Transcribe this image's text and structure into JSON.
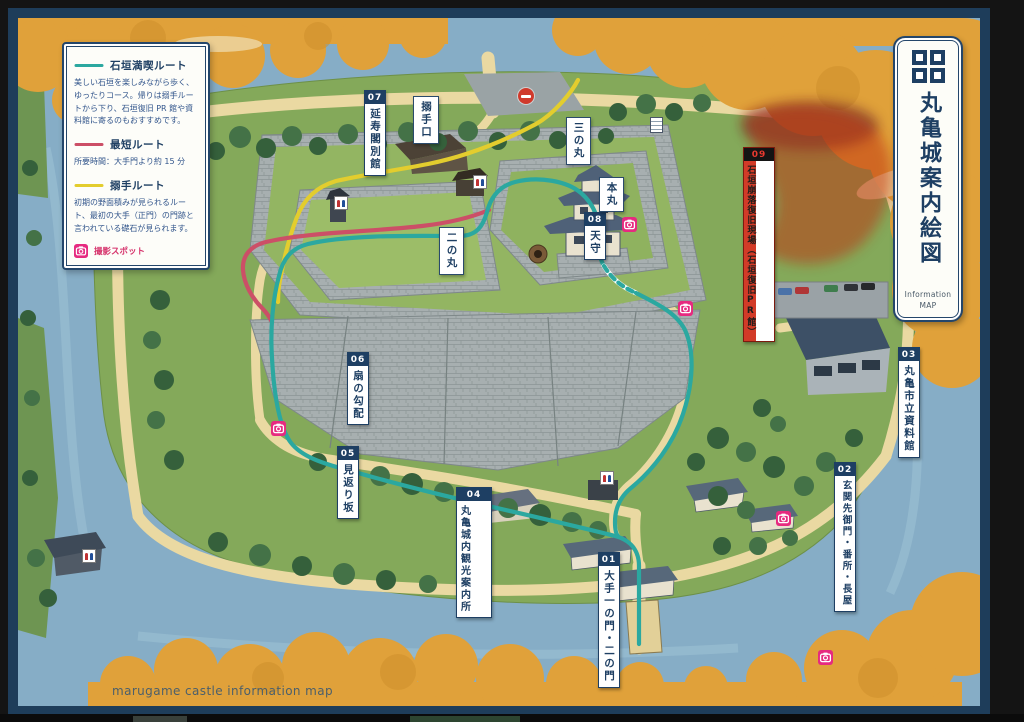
{
  "page": {
    "caption": "marugame castle information map"
  },
  "banner": {
    "title": "丸亀城案内絵図",
    "subtitle1": "Information",
    "subtitle2": "MAP",
    "crest": "marugame-four-squares-crest"
  },
  "legend": {
    "routes": [
      {
        "name": "石垣満喫ルート",
        "color": "#2ba8a0",
        "description": "美しい石垣を楽しみながら歩く、ゆったりコース。帰りは搦手ルートから下り、石垣復旧 PR 館や資料館に寄るのもおすすめです。"
      },
      {
        "name": "最短ルート",
        "color": "#cc4f67",
        "description": "所要時間：大手門より約 15 分"
      },
      {
        "name": "搦手ルート",
        "color": "#e3cd2e",
        "description": "初期の野面積みが見られるルート、最初の大手（正門）の門跡と言われている礎石が見られます。"
      }
    ],
    "photo_spot": "撮影スポット"
  },
  "markers": {
    "m01": {
      "num": "01",
      "label": "大手一の門・二の門"
    },
    "m02": {
      "num": "02",
      "label": "玄関先御門・番所・長屋"
    },
    "m03": {
      "num": "03",
      "label": "丸亀市立資料館"
    },
    "m04": {
      "num": "04",
      "label1": "丸亀城内",
      "label2": "観光案内所"
    },
    "m05": {
      "num": "05",
      "label": "見返り坂"
    },
    "m06": {
      "num": "06",
      "label": "扇の勾配"
    },
    "m07": {
      "num": "07",
      "label": "延寿閣別館"
    },
    "m08": {
      "num": "08",
      "label": "天守"
    },
    "m09": {
      "num": "09",
      "label1": "石垣崩落復旧現場",
      "label2": "（石垣復旧PR館）"
    }
  },
  "place_labels": {
    "karamete": "搦手口",
    "sannomaru": "三の丸",
    "honmaru": "本丸",
    "ninomaru": "二の丸"
  },
  "icons": {
    "photo_spot": {
      "name": "camera-icon",
      "color": "#e62a80"
    },
    "restroom": {
      "name": "restroom-icon"
    },
    "entrance_marker": {
      "name": "red-circle-icon",
      "color": "#d03a2c"
    },
    "signboard": {
      "name": "signboard-icon"
    }
  }
}
